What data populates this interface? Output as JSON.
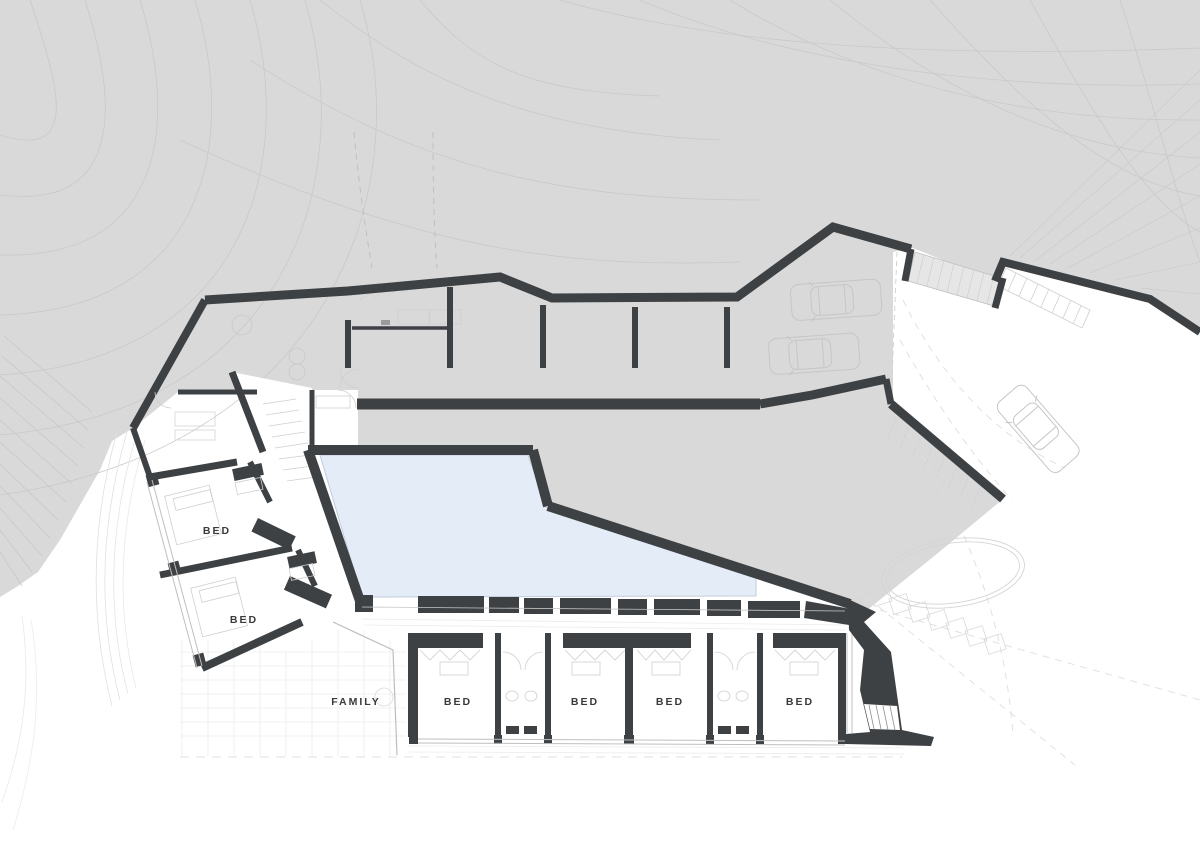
{
  "drawing": {
    "type": "architectural-floor-plan",
    "rooms": [
      {
        "label": "BED",
        "x": 217,
        "y": 531
      },
      {
        "label": "BED",
        "x": 244,
        "y": 620
      },
      {
        "label": "FAMILY",
        "x": 356,
        "y": 702
      },
      {
        "label": "BED",
        "x": 458,
        "y": 702
      },
      {
        "label": "BED",
        "x": 585,
        "y": 702
      },
      {
        "label": "BED",
        "x": 670,
        "y": 702
      },
      {
        "label": "BED",
        "x": 800,
        "y": 702
      }
    ],
    "features": [
      "pool",
      "garage-cars",
      "driveway-car",
      "terrain-contours",
      "oval-lawn",
      "stepping-stones",
      "stairs"
    ],
    "colors": {
      "terrain": "#d9d9d9",
      "contour": "#c9c9c9",
      "wall": "#3e4144",
      "pool": "#e4ecf8",
      "pool_edge": "#c2cdd9",
      "detail": "#cfcfcf",
      "deck_line": "#ececec",
      "label_text": "#3a3a3a"
    }
  }
}
